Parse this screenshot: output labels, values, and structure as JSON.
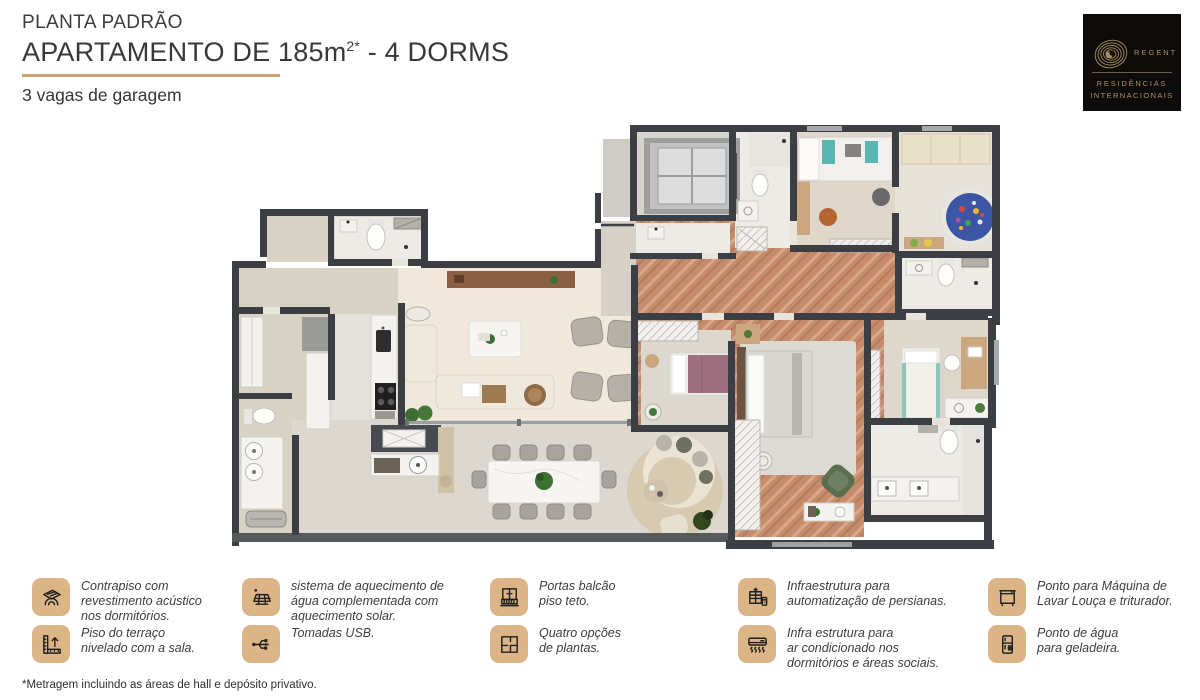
{
  "header": {
    "eyebrow": "PLANTA PADRÃO",
    "title_main": "APARTAMENTO DE 185m",
    "title_sup": "2*",
    "title_tail": " - 4 DORMS",
    "subtitle": "3 vagas de garagem"
  },
  "logo": {
    "brand": "REGENT",
    "line1": "RESIDÊNCIAS",
    "line2": "INTERNACIONAIS"
  },
  "legend": {
    "items": [
      {
        "icon": "acoustic-floor-icon",
        "text": "Contrapiso com\nrevestimento acústico\nnos dormitórios."
      },
      {
        "icon": "terrace-level-icon",
        "text": "Piso do terraço\nnivelado com a sala."
      },
      {
        "icon": "solar-heating-icon",
        "text": "sistema de aquecimento de\nágua complementada com\naquecimento solar."
      },
      {
        "icon": "usb-outlet-icon",
        "text": "Tomadas USB."
      },
      {
        "icon": "balcony-door-icon",
        "text": "Portas balcão\npiso teto."
      },
      {
        "icon": "floorplan-options-icon",
        "text": "Quatro opções\nde plantas."
      },
      {
        "icon": "blinds-automation-icon",
        "text": "Infraestrutura para\nautomatização de persianas."
      },
      {
        "icon": "air-conditioning-icon",
        "text": "Infra estrutura para\nar condicionado nos\ndormitórios e áreas sociais."
      },
      {
        "icon": "dishwasher-point-icon",
        "text": "Ponto para Máquina de\nLavar Louça e triturador."
      },
      {
        "icon": "fridge-water-icon",
        "text": "Ponto de água\npara geladeira."
      }
    ]
  },
  "footnote": "*Metragem incluindo as áreas de hall e depósito privativo.",
  "palette": {
    "accent_underline": "#c9a175",
    "legend_icon_bg": "#dcb587",
    "logo_gold": "#ad9066",
    "logo_bg": "#0d0c0a",
    "wall": "#3b3e42",
    "floor_beige": "#d8d2c5",
    "floor_cream": "#f0e8da",
    "floor_terrace": "#dcd8d0",
    "floor_marble": "#edebe6",
    "floor_herringbone": "#c58b6b"
  }
}
